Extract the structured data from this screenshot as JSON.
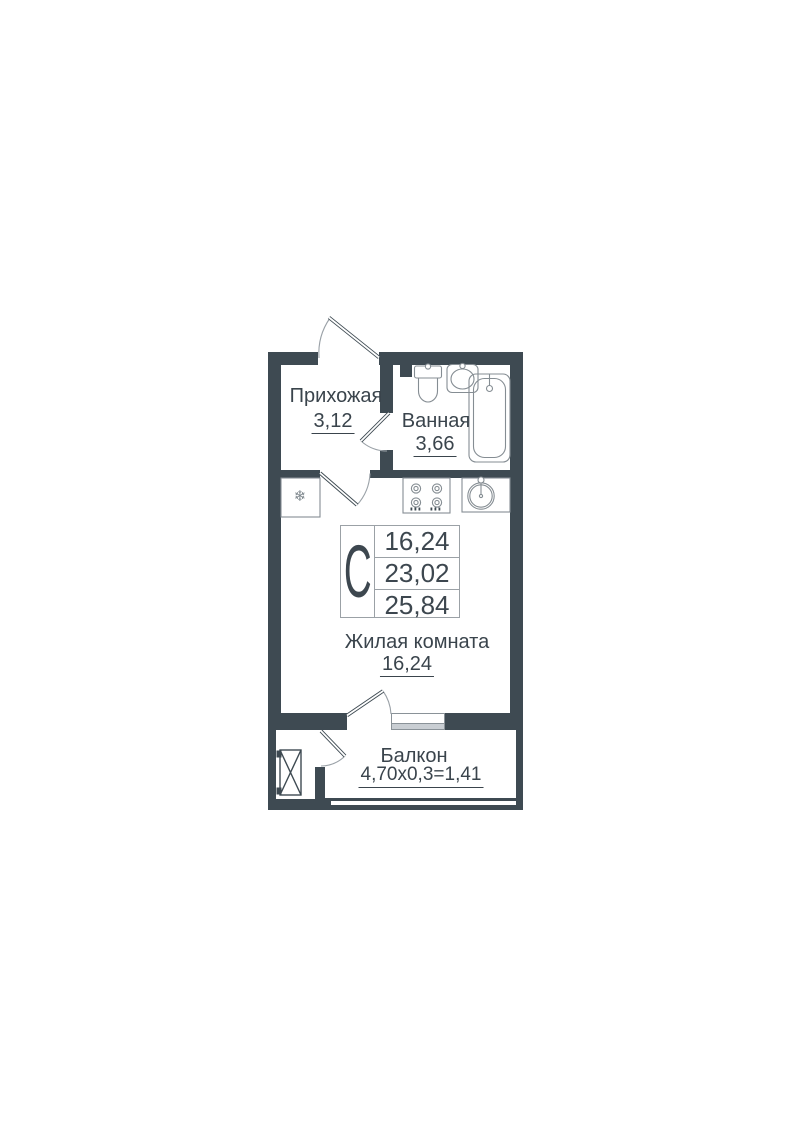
{
  "stats": {
    "letter": "С",
    "values": [
      "16,24",
      "23,02",
      "25,84"
    ]
  },
  "rooms": {
    "hallway": {
      "label": "Прихожая",
      "area": "3,12"
    },
    "bathroom": {
      "label": "Ванная",
      "area": "3,66"
    },
    "living": {
      "label": "Жилая комната",
      "area": "16,24"
    },
    "balcony": {
      "label": "Балкон",
      "area": "4,70х0,3=1,41"
    }
  },
  "icons": {
    "fridge_snowflake": "❄"
  },
  "colors": {
    "wall": "#3E4A52",
    "text": "#3A444C",
    "fixture_line": "#858D93",
    "door_arc": "#9AA1A7",
    "window_sill": "#C9CED3",
    "table_border": "#9BA1A6"
  }
}
